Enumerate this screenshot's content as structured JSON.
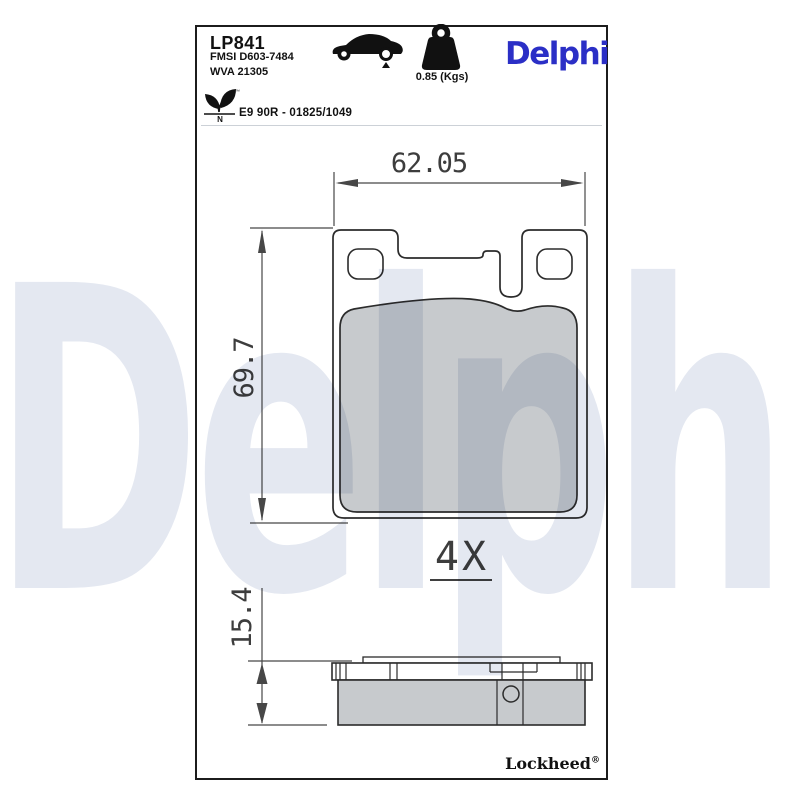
{
  "watermark": {
    "text": "Delphi",
    "color": "#e4e8f1"
  },
  "header": {
    "part_number": "LP841",
    "fmsi_code": "FMSI D603-7484",
    "wva_code": "WVA 21305",
    "weight": "0.85 (Kgs)",
    "brand_logo": "Delphi",
    "brand_color": "#2b2fc6",
    "approval_code": "E9 90R - 01825/1049",
    "eco_mark_letter": "N",
    "eco_mark_tm": "™",
    "icons": {
      "car": "car-rear-axle-icon",
      "weight": "weight-kg-icon",
      "leaf": "eco-leaf-icon"
    }
  },
  "drawing": {
    "front_view": {
      "width_mm": "62.05",
      "height_mm": "69.7"
    },
    "side_view": {
      "thickness_mm": "15.4"
    },
    "quantity": "4X",
    "pad_fill_color": "#c7cacd",
    "line_color": "#2b2b2b"
  },
  "footer": {
    "manufacturer": "Lockheed",
    "registered_mark": "®"
  }
}
